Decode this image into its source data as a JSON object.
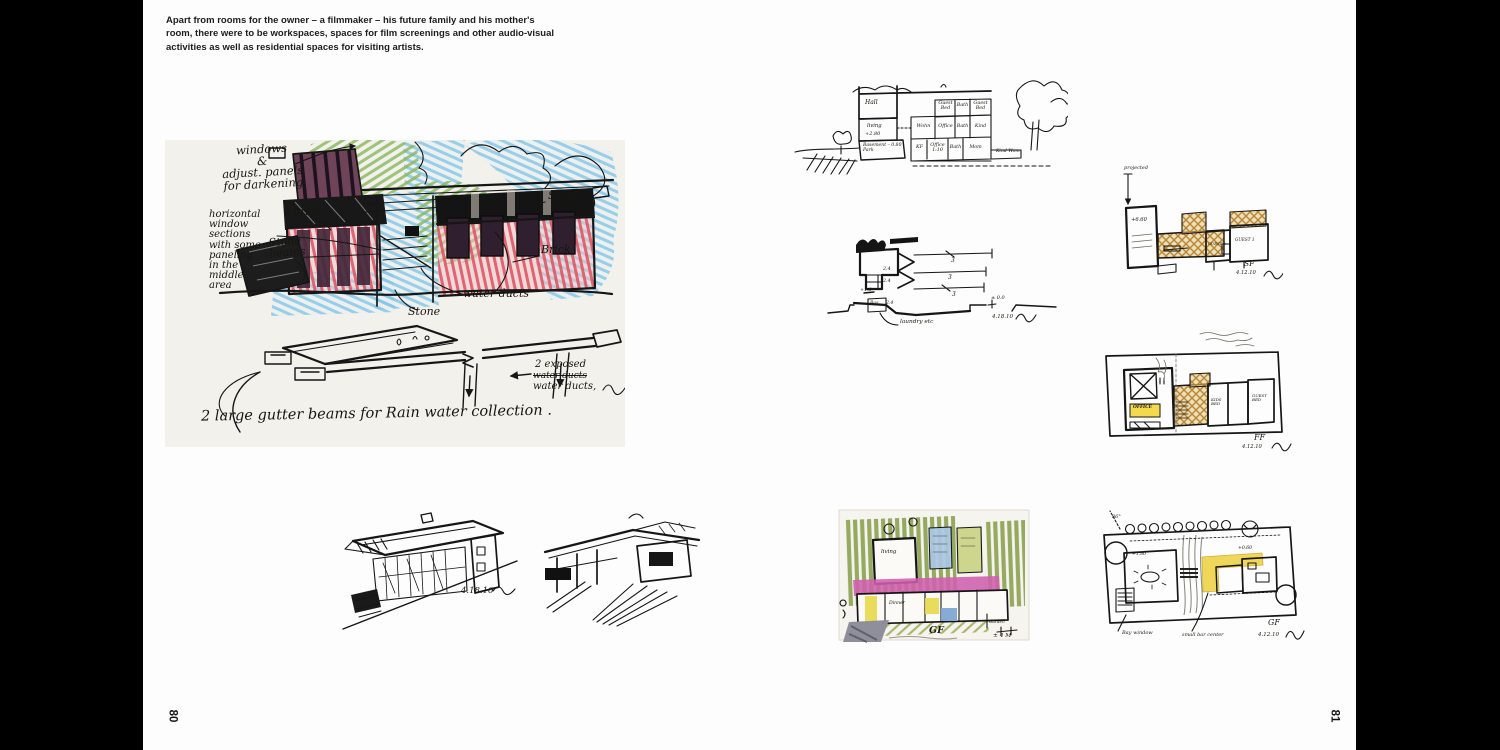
{
  "spread": {
    "caption": "Apart from rooms for the owner – a filmmaker – his future family and his mother's\nroom, there were to be workspaces, spaces for film screenings and other audio-visual\nactivities as well as residential spaces for visiting artists.",
    "left_page_number": "80",
    "right_page_number": "81"
  },
  "elevation_sketch": {
    "windows_note": "windows\n&\nadjust. panels\nfor darkening",
    "horizontal_note": "horizontal\nwindow\nsections\nwith some\npaneling\nin the\nmiddle\narea",
    "brick_left": "Brick",
    "stone_right": "Stone",
    "stone_beams": "Stone\nbeams",
    "brick_right": "Brick",
    "water_ducts": "water ducts",
    "stone_bottom": "Stone",
    "exposed_line1": "2 exposed",
    "exposed_struck": "water ducts",
    "exposed_line2": "water ducts,",
    "gutter_caption": "2 large gutter beams for Rain water collection ."
  },
  "perspective_sketch": {
    "date": "4.18.10"
  },
  "section_elevation_sketch": {
    "hall": "Hall",
    "cells_top": [
      "Guest Bed",
      "Bath",
      "Guest Bed"
    ],
    "cells_mid": [
      "Wohn",
      "Office",
      "Bath",
      "Kind"
    ],
    "cells_bottom": [
      "KF",
      "Office 1:10",
      "Bath",
      "Mom"
    ],
    "living": "living",
    "level": "+2.80",
    "basement": "Basement – 0.80 | Park",
    "right_note": "Kind Wom"
  },
  "section_sketch": {
    "dim_a": "2.4",
    "dim_b": "2.4",
    "level": "+1.8",
    "dim_c": "2.4",
    "bay1": "3",
    "bay2": "3",
    "bay3": "3",
    "datum": "± 0.0",
    "basement": "Bas.",
    "laundry": "laundry etc",
    "date": "4.18.10"
  },
  "sf_plan": {
    "projected": "projected",
    "level": "+6.60",
    "guest2": "GUEST 2",
    "guest1": "GUEST 1",
    "floor": "SF",
    "date": "4.12.10"
  },
  "ff_plan": {
    "office": "OFFICE",
    "kids_bed": "KIDS BED",
    "guest_bed": "GUEST BED",
    "floor": "FF",
    "date": "4.12.10"
  },
  "gf_color_plan": {
    "living": "living",
    "dinner": "Dinner",
    "floor": "GF",
    "garden": "Garden",
    "dim": "± 4 M"
  },
  "gf_plan": {
    "angle": "86°",
    "level1": "+1.80",
    "level2": "+0.60",
    "bay_window": "Bay window",
    "center_note": "small bar center",
    "floor": "GF",
    "date": "4.12.10"
  },
  "colors": {
    "ink": "#161616",
    "paper": "#f2f1ec",
    "page": "#fdfdfd",
    "crayon_blue": "#7fc0e2",
    "crayon_green": "#88b75e",
    "crayon_red": "#d9525f",
    "panel_dark": "#42283a",
    "tan": "#c9984e",
    "yellow": "#f0d44c",
    "magenta": "#d05fae",
    "olive": "#8ba152"
  }
}
